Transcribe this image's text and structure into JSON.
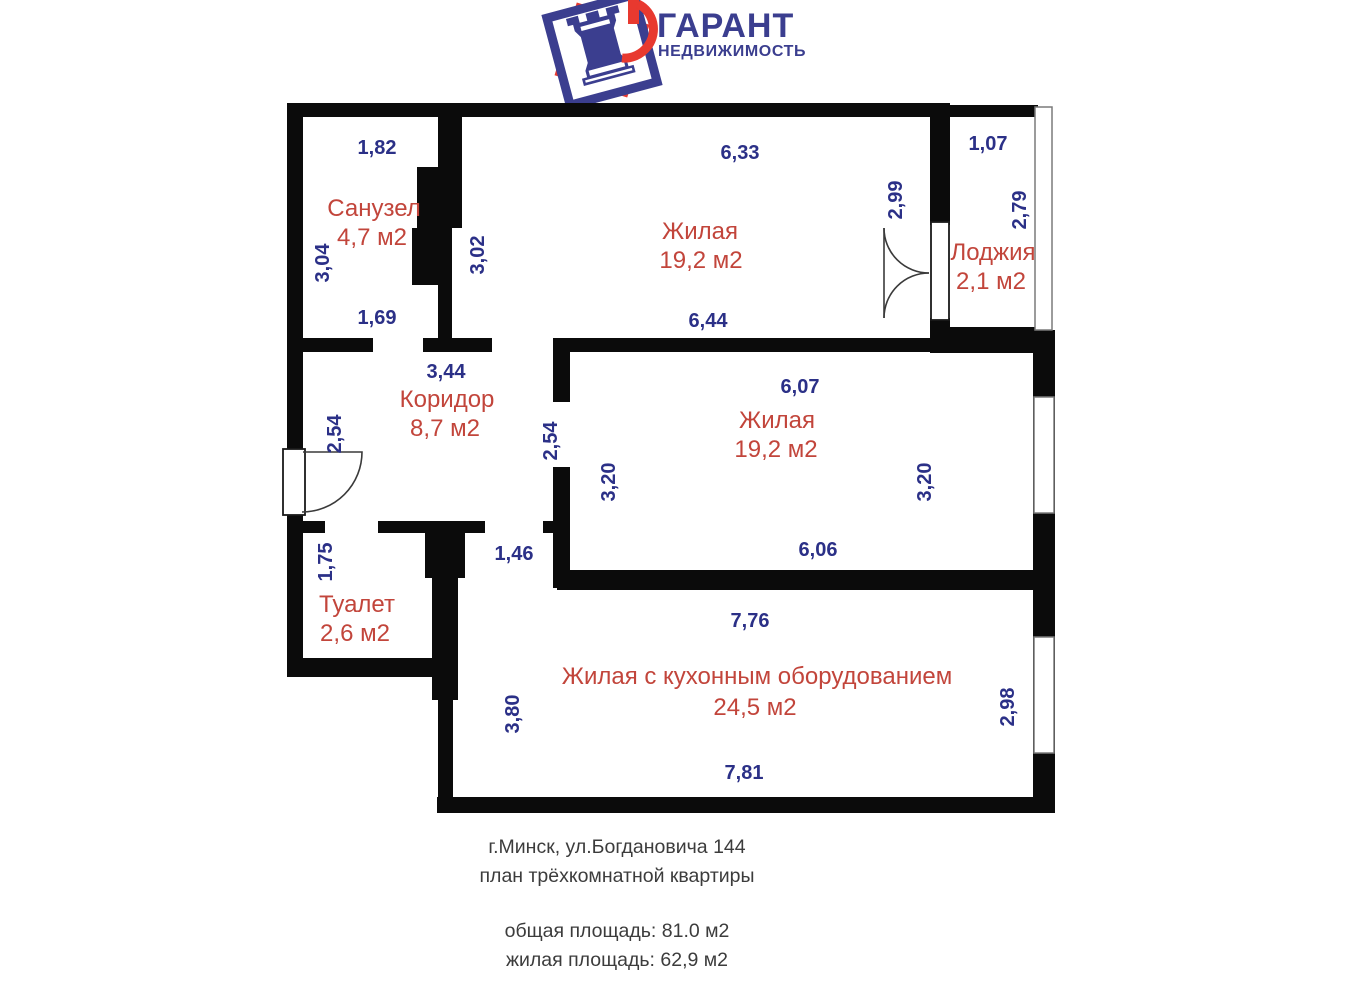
{
  "logo": {
    "title": "ГАРАНТ",
    "subtitle": "НЕДВИЖИМОСТЬ",
    "icon": "chess-rook-key-in-tilted-square",
    "brand_blue": "#3b3e8f",
    "brand_red": "#e8392f"
  },
  "plan": {
    "wall_color": "#0b0b0b",
    "dimension_color": "#2b3087",
    "room_label_color": "#c2453b",
    "rooms": [
      {
        "name": "Санузел",
        "area": "4,7 м2"
      },
      {
        "name": "Жилая",
        "area": "19,2 м2"
      },
      {
        "name": "Лоджия",
        "area": "2,1 м2"
      },
      {
        "name": "Коридор",
        "area": "8,7 м2"
      },
      {
        "name": "Жилая",
        "area": "19,2 м2"
      },
      {
        "name": "Туалет",
        "area": "2,6 м2"
      },
      {
        "name": "Жилая с кухонным оборудованием",
        "area": "24,5 м2"
      }
    ],
    "dimensions": [
      {
        "value": "1,82"
      },
      {
        "value": "6,33"
      },
      {
        "value": "1,07"
      },
      {
        "value": "3,04"
      },
      {
        "value": "3,02"
      },
      {
        "value": "2,99"
      },
      {
        "value": "2,79"
      },
      {
        "value": "1,69"
      },
      {
        "value": "6,44"
      },
      {
        "value": "3,44"
      },
      {
        "value": "2,54"
      },
      {
        "value": "2,54"
      },
      {
        "value": "6,07"
      },
      {
        "value": "3,20"
      },
      {
        "value": "3,20"
      },
      {
        "value": "6,06"
      },
      {
        "value": "1,75"
      },
      {
        "value": "1,46"
      },
      {
        "value": "7,76"
      },
      {
        "value": "3,80"
      },
      {
        "value": "2,98"
      },
      {
        "value": "7,81"
      }
    ]
  },
  "footer": {
    "address": "г.Минск, ул.Богдановича 144",
    "plan_type": "план трёхкомнатной квартиры",
    "total_area": "общая площадь: 81.0 м2",
    "living_area": "жилая площадь: 62,9 м2"
  }
}
